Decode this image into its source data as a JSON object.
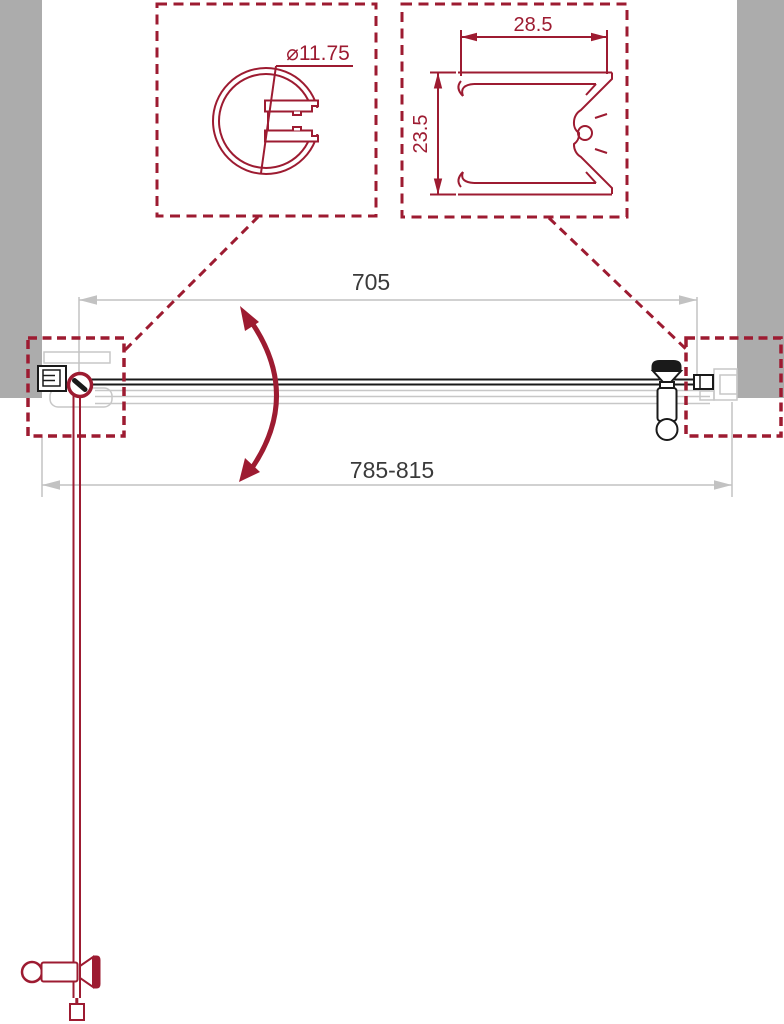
{
  "colors": {
    "accent": "#9d1b31",
    "ink": "#1a1a1a",
    "wall": "#acacac",
    "dimline": "#c2c2c2",
    "dimtext": "#3a3a3a",
    "ghost": "#c7c7c7"
  },
  "labels": {
    "door_width": "705",
    "overall_width": "785-815",
    "hinge_profile_diameter": "⌀11.75",
    "wall_profile_width": "28.5",
    "wall_profile_height": "23.5"
  }
}
